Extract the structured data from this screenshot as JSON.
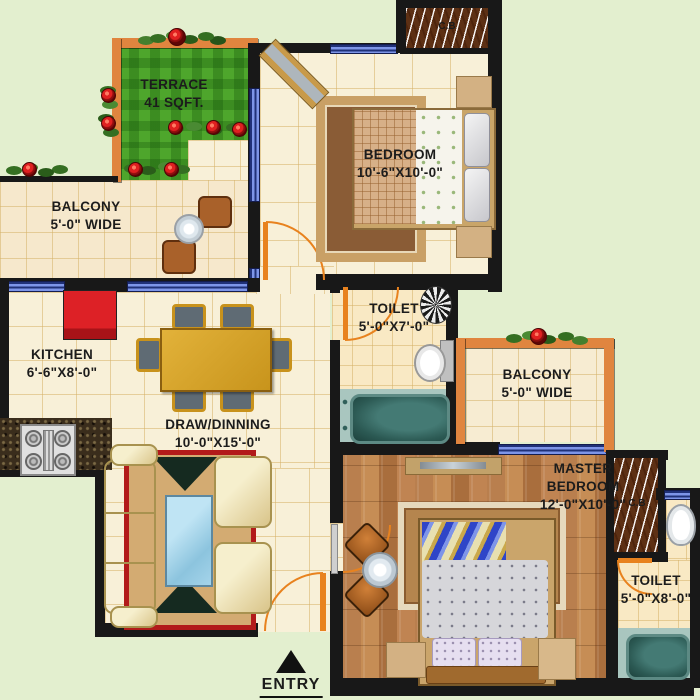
{
  "plan": {
    "colors": {
      "outside": "#e3efcf",
      "wall": "#181818",
      "window_blue": "#7d95e8",
      "terrace_wall_orange": "#e0853f",
      "door_orange": "#e8821e",
      "grass_green": "#4ea62c",
      "floor_tile": "#f8f0d8",
      "wood_floor": "#b97f4e",
      "bath_teal": "#a9c6bf",
      "carpet_red": "#b21a1a",
      "fridge_red": "#dd2126"
    },
    "rooms": {
      "terrace": {
        "name": "TERRACE",
        "dim": "41 SQFT."
      },
      "balcony_left": {
        "name": "BALCONY",
        "dim": "5'-0\" WIDE"
      },
      "bedroom": {
        "name": "BEDROOM",
        "dim": "10'-6\"X10'-0\""
      },
      "toilet_top": {
        "name": "TOILET",
        "dim": "5'-0\"X7'-0\""
      },
      "kitchen": {
        "name": "KITCHEN",
        "dim": "6'-6\"X8'-0\""
      },
      "draw_dining": {
        "name": "DRAW/DINNING",
        "dim": "10'-0\"X15'-0\""
      },
      "balcony_right": {
        "name": "BALCONY",
        "dim": "5'-0\" WIDE"
      },
      "master_bedroom": {
        "line1": "MASTER",
        "line2": "BEDROOM",
        "dim": "12'-0\"X10'-0\""
      },
      "toilet_bottom": {
        "name": "TOILET",
        "dim": "5'-0\"X8'-0\""
      }
    },
    "cupboards": {
      "top": "C.B",
      "right": "C.B"
    },
    "entry": {
      "label": "ENTRY"
    }
  }
}
